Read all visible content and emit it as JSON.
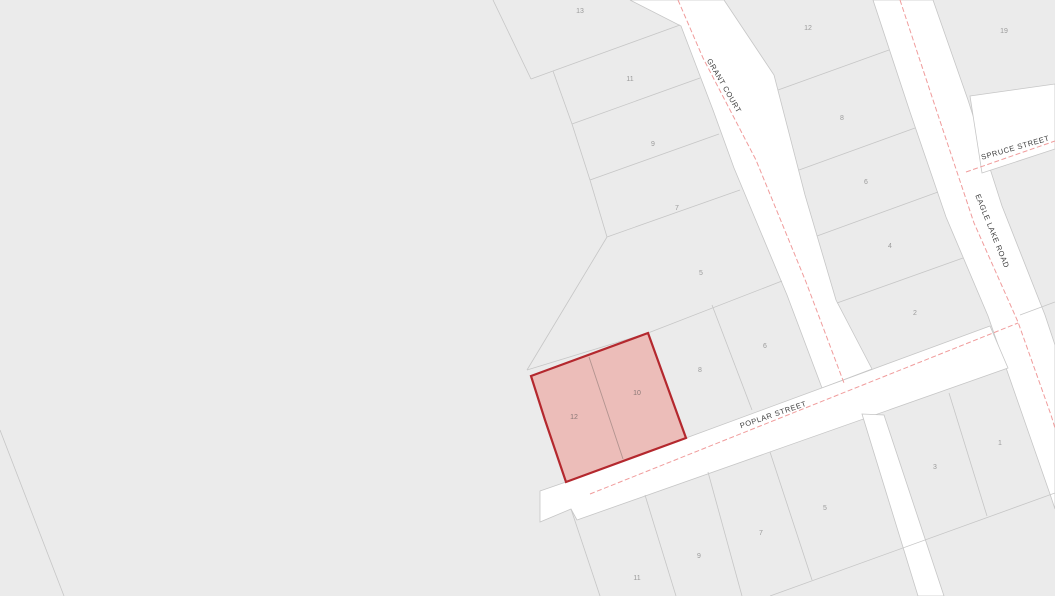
{
  "map": {
    "title": "parcel-map-view",
    "background_color": "#ebebeb",
    "street_color": "#ffffff",
    "parcel_line_color": "#c6c6c6",
    "centerline_color": "#f09c9c",
    "lot_label_color": "#9b9b9b",
    "street_label_color": "#3d3d3d",
    "highlight": {
      "fill": "#ecb8b4",
      "fill_opacity": 0.9,
      "stroke": "#b4282e",
      "stroke_width": 2.2,
      "divider_color": "#b2938f",
      "outline": "648,333 686,438 566,482 545,420 531,376",
      "divider": "M589,357 L623,459",
      "lots": [
        {
          "label": "12",
          "x": 574,
          "y": 419
        },
        {
          "label": "10",
          "x": 637,
          "y": 395
        }
      ]
    },
    "streets": [
      {
        "id": "grant-court",
        "label": "GRANT COURT",
        "poly": "630,0 681,26 713,110 734,168 787,295 822,388 872,369 836,300 805,195 774,75 724,0",
        "centerline": "M678,0 L703,58 L756,160 L806,282 L844,383",
        "label_x": 722,
        "label_y": 87,
        "label_rotation": 60
      },
      {
        "id": "eagle-lake-road",
        "label": "EAGLE LAKE ROAD",
        "poly": "873,0 910,112 946,217 988,316 1051,497 1055,509 1055,345 1045,315 1002,206 968,100 933,0",
        "centerline": "M900,0 L938,115 L974,223 L1018,322 L1051,415 L1055,428",
        "label_x": 990,
        "label_y": 232,
        "label_rotation": 68
      },
      {
        "id": "spruce-street",
        "label": "SPRUCE STREET",
        "poly": "970,96 1055,84 1055,149 982,173",
        "centerline": "M966,172 L1055,141",
        "label_x": 1016,
        "label_y": 150,
        "label_rotation": -16
      },
      {
        "id": "poplar-street",
        "label": "POPLAR STREET",
        "poly": "540,491 566,482 686,438 990,326 1008,368 577,520 571,509 540,522",
        "centerline": "M590,494 L1018,323",
        "label_x": 774,
        "label_y": 417,
        "label_rotation": -19
      },
      {
        "id": "unnamed-street",
        "label": "",
        "poly": "862,414 884,415 944,596 918,596",
        "centerline": "",
        "label_x": 0,
        "label_y": 0,
        "label_rotation": 0
      }
    ],
    "parcel_lines": [
      "M493,0 L531,79",
      "M531,79 L553,71",
      "M553,71 L680,25",
      "M553,71 L572,124",
      "M572,124 L700,78",
      "M572,124 L590,180",
      "M590,180 L719,134",
      "M590,180 L607,237",
      "M607,237 L740,190",
      "M607,237 L527,370",
      "M527,370 L648,333 L782,281",
      "M712,305 L752,410",
      "M778,90 L889,50",
      "M799,170 L915,128",
      "M817,236 L938,192",
      "M837,303 L963,258",
      "M949,393 L987,516",
      "M645,495 L676,596",
      "M708,472 L742,596",
      "M770,452 L812,580",
      "M571,509 L600,596",
      "M770,596 L1055,493",
      "M0,430 L64,596",
      "M1020,315 L1055,302"
    ],
    "lots": [
      {
        "label": "13",
        "x": 580,
        "y": 13
      },
      {
        "label": "11",
        "x": 630,
        "y": 81
      },
      {
        "label": "9",
        "x": 653,
        "y": 146
      },
      {
        "label": "7",
        "x": 677,
        "y": 210
      },
      {
        "label": "5",
        "x": 701,
        "y": 275
      },
      {
        "label": "12",
        "x": 808,
        "y": 30
      },
      {
        "label": "8",
        "x": 842,
        "y": 120
      },
      {
        "label": "6",
        "x": 866,
        "y": 184
      },
      {
        "label": "4",
        "x": 890,
        "y": 248
      },
      {
        "label": "2",
        "x": 915,
        "y": 315
      },
      {
        "label": "19",
        "x": 1004,
        "y": 33
      },
      {
        "label": "8",
        "x": 700,
        "y": 372
      },
      {
        "label": "6",
        "x": 765,
        "y": 348
      },
      {
        "label": "3",
        "x": 935,
        "y": 469
      },
      {
        "label": "1",
        "x": 1000,
        "y": 445
      },
      {
        "label": "11",
        "x": 637,
        "y": 580
      },
      {
        "label": "9",
        "x": 699,
        "y": 558
      },
      {
        "label": "7",
        "x": 761,
        "y": 535
      },
      {
        "label": "5",
        "x": 825,
        "y": 510
      }
    ]
  }
}
